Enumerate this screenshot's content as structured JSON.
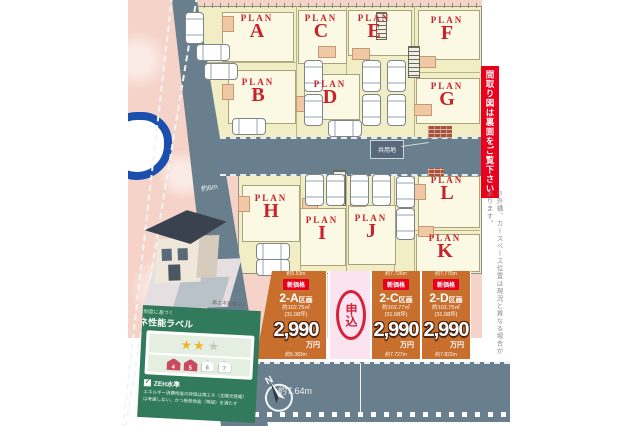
{
  "plan_prefix": "PLAN",
  "plans": [
    "A",
    "B",
    "C",
    "D",
    "E",
    "F",
    "G",
    "H",
    "I",
    "J",
    "K",
    "L"
  ],
  "roads": {
    "shared_area_label": "共用地",
    "front_road_width": "約6m",
    "south_road_width": "約7.64m",
    "compass": "N"
  },
  "side_notes": {
    "red_banner": "間取り図は裏面をご覧下さい",
    "caution_vertical": "※外構、カースペース位置は現況と異なる場合があります。"
  },
  "price_lots": [
    {
      "badge": "新価格",
      "name": "2-A",
      "name_suffix": "区画",
      "area": "約102.75㎡",
      "tsubo": "(31.08坪)",
      "price": "2,990",
      "unit": "万円",
      "dim_top": "約5.53m",
      "dim_bottom": "約5.383m"
    },
    {
      "status": "申込"
    },
    {
      "badge": "新価格",
      "name": "2-C",
      "name_suffix": "区画",
      "area": "約102.77㎡",
      "tsubo": "(31.08坪)",
      "price": "2,990",
      "unit": "万円",
      "dim_top": "約7.726m",
      "dim_bottom": "約7.727m"
    },
    {
      "badge": "新価格",
      "name": "2-D",
      "name_suffix": "区画",
      "area": "約102.75㎡",
      "tsubo": "(31.08坪)",
      "price": "2,990",
      "unit": "万円",
      "dim_top": "約7.775m",
      "dim_bottom": "約7.822m"
    }
  ],
  "energy_label": {
    "note_above": "再エネ設備なし",
    "header_small": "表示制度に基づく",
    "header_title": "省エネ性能ラベル",
    "stars_filled": "★★",
    "stars_empty": "★",
    "house_numbers": [
      "4",
      "5",
      "6",
      "7"
    ],
    "zeh_check": "✓",
    "zeh": "ZEH水準",
    "desc_line1": "エネルギー消費性能の評価は再エネ（太陽光発電）",
    "desc_line2": "は考慮しない、かつ断熱性能（等級）を満たす"
  }
}
